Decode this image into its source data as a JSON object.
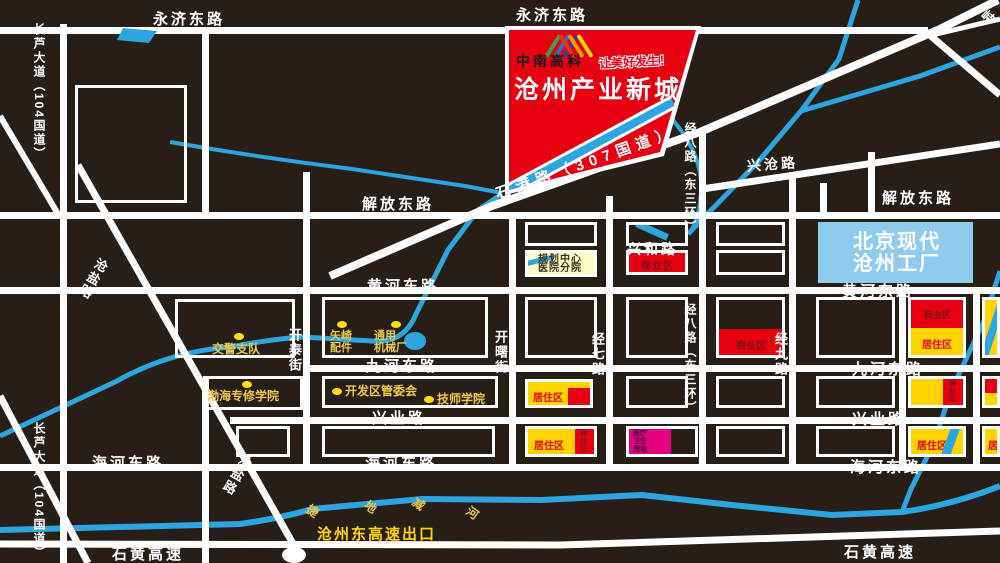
{
  "banner": {
    "logo": "中南高科",
    "slogan": "让美好发生！",
    "title": "沧州产业新城"
  },
  "roads": {
    "yongji": "永济东路",
    "jiefang": "解放东路",
    "huanghe": "黄河东路",
    "jiuhe": "九河东路",
    "xingye": "兴业路",
    "haihe": "海河东路",
    "shihuang": "石黄高速",
    "changlu": "长芦大道（104国道）",
    "cangyan": "沧盐路",
    "kaitai": "开泰街",
    "kaishu": "开曙街",
    "jingqi": "经七路",
    "jingba": "经八路（东三环）",
    "jingjiu": "经九路",
    "shigang": "石港路（307国道）",
    "xingcang": "兴沧路",
    "xinghe": "兴和路",
    "corner_partial": "峙"
  },
  "river_name": {
    "c1": "捷",
    "c2": "地",
    "c3": "减",
    "c4": "河"
  },
  "pois": {
    "traffic_police": "交警支队",
    "yazaki_l1": "矢崎",
    "yazaki_l2": "配件",
    "machinery_l1": "通用",
    "machinery_l2": "机械厂",
    "bohai_college": "渤海专修学院",
    "committee": "开发区管委会",
    "tech_college": "技师学院"
  },
  "zones": {
    "hospital": "规划中心医院分院",
    "commercial": "商业区",
    "residential": "居住区",
    "medical": "医疗卫生用地",
    "residential_partial": "居",
    "factory": "北京现代沧州工厂"
  },
  "labels": {
    "highway_exit": "沧州东高速出口"
  },
  "colors": {
    "background": "#281E18",
    "road": "#FFFFFF",
    "river": "#2CA6E0",
    "zone_red": "#E60012",
    "zone_yellow": "#FFD400",
    "zone_magenta": "#E4007F",
    "factory_blue": "#8FCBEC",
    "hospital_cream": "#FFFBC4",
    "poi_gold": "#E9C94E",
    "banner_red": "#E60012"
  }
}
